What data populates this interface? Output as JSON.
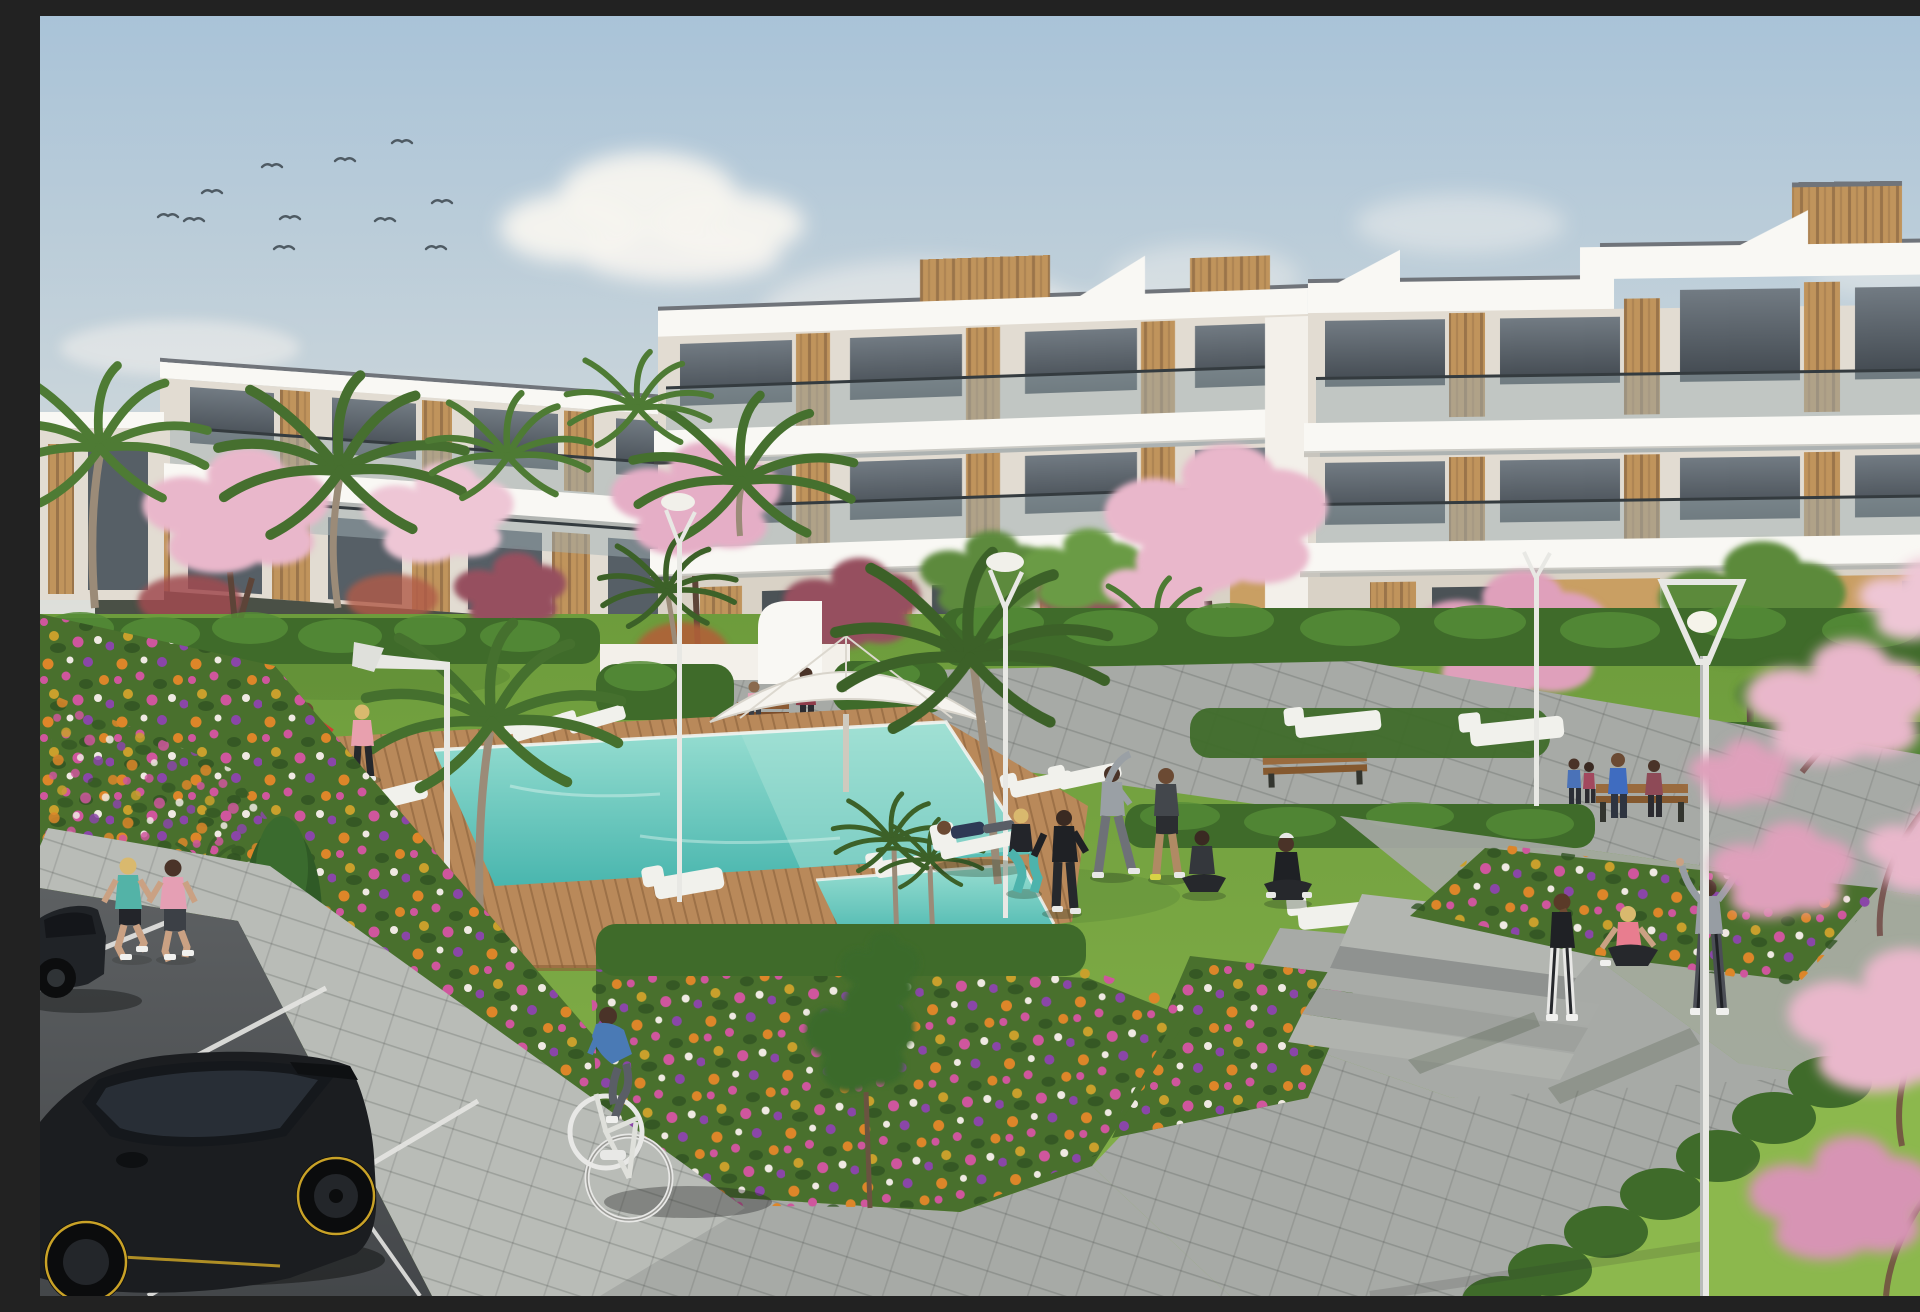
{
  "scene": {
    "type": "photorealistic architectural render",
    "description": "New-build white apartment complex seen across a landscaped garden: communal turquoise pool with wooden deck, white sun loungers and a parasol, residents exercising on the lawn, joggers and a cyclist on the paths, flower beds of orange, magenta and purple blooms, palm and pink cherry-blossom trees, street lamps, and black cars in a foreground parking area under a pale blue sky with birds.",
    "time_of_day": "late afternoon sunshine"
  },
  "palette": {
    "c-sky-top": "#a9c3d8",
    "c-sky-horizon": "#e9e5da",
    "c-cloud": "#f7f4ef",
    "c-bird": "#4e5a63",
    "c-wall": "#f3f0ea",
    "c-wall-shade": "#e2dcd2",
    "c-wall-dark": "#cfc8bb",
    "c-slab": "#f9f8f4",
    "c-roof-edge": "#70747a",
    "c-glass": "#565f66",
    "c-balustrade": "#9fb0b4",
    "c-rail": "#343b3f",
    "c-wood": "#c0945c",
    "c-wood-dark": "#97713f",
    "c-tan": "#c99f63",
    "c-grass": "#74a23f",
    "c-grass-light": "#8cb84d",
    "c-hedge": "#3f6b2a",
    "c-hedge-light": "#558c37",
    "c-deck": "#b9895a",
    "c-deck-dark": "#8a5f36",
    "c-water": "#49b6ae",
    "c-water-light": "#a8e2d6",
    "c-path": "#a7aaa6",
    "c-path-light": "#b9bcb7",
    "c-path-shadow": "#8f9290",
    "c-road": "#55585a",
    "c-line": "#e6e6e3",
    "c-car": "#1b1d20",
    "c-car-highlight": "#3c4147",
    "c-rim-accent": "#c9a227",
    "c-lamp": "#e8e8e4",
    "c-blossom": "#e9b7cb",
    "c-blossom-deep": "#d794b4",
    "c-plum": "#96505f",
    "c-palm": "#4e7b34",
    "c-palm-dark": "#3c6128",
    "c-flower-orange": "#dd8629",
    "c-flower-magenta": "#cf569d",
    "c-flower-purple": "#8a46a8",
    "c-flower-gold": "#c9a02c",
    "c-flower-white": "#efe9e2",
    "c-skin": "#caa183"
  },
  "inventory": {
    "birds_in_sky": 11,
    "street_lamps": 5,
    "sun_loungers": 11,
    "benches": 3,
    "parasols": 2,
    "pools": 2,
    "vehicles": [
      {
        "type": "hatchback car",
        "color": "black with yellow rim accents"
      },
      {
        "type": "sedan car, partially visible",
        "color": "black"
      },
      {
        "type": "bicycle",
        "color": "white"
      }
    ],
    "trees": {
      "palms": 10,
      "cherry_blossom": 5,
      "plum_red": 3,
      "green_deciduous": 4,
      "conifer": 1
    },
    "flower_colors": [
      "orange",
      "magenta",
      "purple",
      "gold",
      "white"
    ],
    "people": [
      {
        "role": "jogger woman",
        "top": "teal"
      },
      {
        "role": "jogger woman",
        "top": "pink"
      },
      {
        "role": "man playing ball",
        "top": "gray"
      },
      {
        "role": "man kicking ball",
        "top": "red"
      },
      {
        "role": "woman playing ball",
        "top": "pink"
      },
      {
        "role": "man reclining on deck chair",
        "top": "navy"
      },
      {
        "role": "woman squatting",
        "top": "black, teal leggings"
      },
      {
        "role": "person in tracksuit",
        "top": "black"
      },
      {
        "role": "man stretching arm up",
        "top": "light gray"
      },
      {
        "role": "man exercising in shorts",
        "top": "charcoal"
      },
      {
        "role": "person seated cross-legged",
        "top": "dark gray"
      },
      {
        "role": "meditating person with white cap",
        "top": "black"
      },
      {
        "role": "standing woman",
        "top": "black tank, white leggings"
      },
      {
        "role": "woman sitting on platform",
        "top": "coral pink"
      },
      {
        "role": "person stretching arms in V",
        "top": "gray hoodie"
      },
      {
        "role": "man on bench",
        "top": "blue"
      },
      {
        "role": "woman on bench",
        "top": "maroon"
      },
      {
        "role": "walking man",
        "top": "blue"
      },
      {
        "role": "walking woman",
        "top": "crimson"
      },
      {
        "role": "woman with purple bag",
        "top": "dark red"
      },
      {
        "role": "child",
        "top": "pink"
      },
      {
        "role": "cyclist",
        "top": "blue"
      }
    ]
  }
}
